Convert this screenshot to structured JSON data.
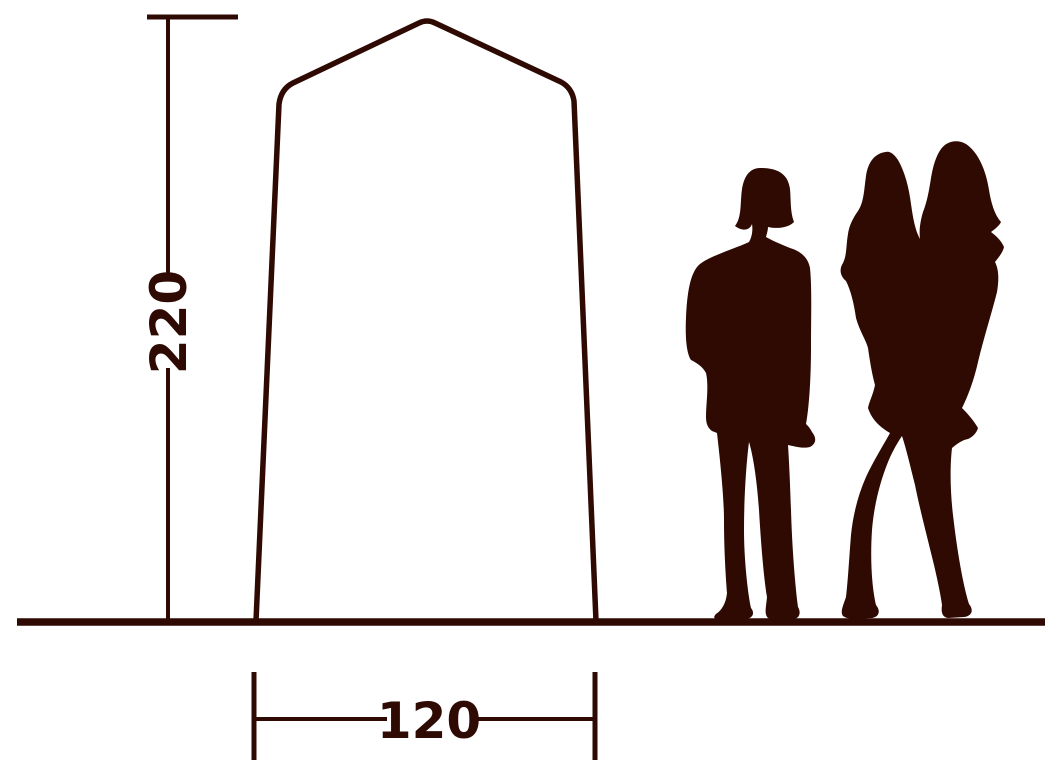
{
  "diagram": {
    "background": "#ffffff",
    "ink": "#2e0a02",
    "height_dimension": {
      "label": "220"
    },
    "width_dimension": {
      "label": "120"
    },
    "tent": {
      "name": "tent-front-outline"
    },
    "people": {
      "left": "standing-woman-silhouette",
      "right": "woman-holding-child-silhouette"
    }
  }
}
